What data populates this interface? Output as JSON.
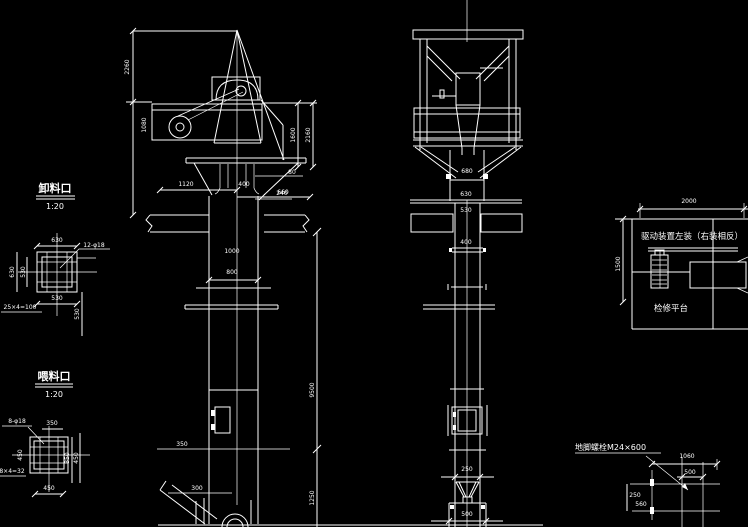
{
  "canvas": {
    "bg_color": "#000000",
    "line_color": "#ffffff"
  },
  "details": {
    "discharge": {
      "title": "卸料口",
      "scale": "1:20",
      "dim_top": "630",
      "dim_bottom": "530",
      "dim_left_outer": "630",
      "dim_left_inner": "530",
      "dim_right": "530",
      "bolt_note": "12-φ18",
      "pitch_note": "25×4=100"
    },
    "feed": {
      "title": "喂料口",
      "scale": "1:20",
      "dim_top": "350",
      "dim_bottom": "450",
      "dim_left": "450",
      "dim_right_outer": "450",
      "dim_right_inner": "350",
      "bolt_note": "8-φ18",
      "pitch_note": "8×4=32"
    },
    "drive": {
      "note": "驱动装置左装（右装相反）",
      "platform_label": "检修平台",
      "dim_top": "2000",
      "dim_left": "1500"
    },
    "anchor": {
      "note": "地脚螺栓M24×600",
      "dim_top": "1060",
      "dim_mid": "500",
      "dim_left_top": "250",
      "dim_left_bottom": "560"
    }
  },
  "front_view": {
    "dims": {
      "left_overall": "2260",
      "left_upper": "1080",
      "head_inner": "1600",
      "head_outer": "2160",
      "top_w1": "1120",
      "top_w2": "400",
      "top_w3": "660",
      "below_slab1": "1000",
      "below_slab2": "800",
      "offset_r1": "80",
      "offset_r2": "240",
      "door_h": "350",
      "door_w": "300",
      "height_upper": "9500",
      "height_lower": "1250"
    }
  },
  "side_view": {
    "dims": {
      "head_w": "680",
      "neck_w1": "630",
      "neck_w2": "530",
      "casing_w": "400",
      "funnel_w": "250",
      "boot_w": "500"
    }
  }
}
